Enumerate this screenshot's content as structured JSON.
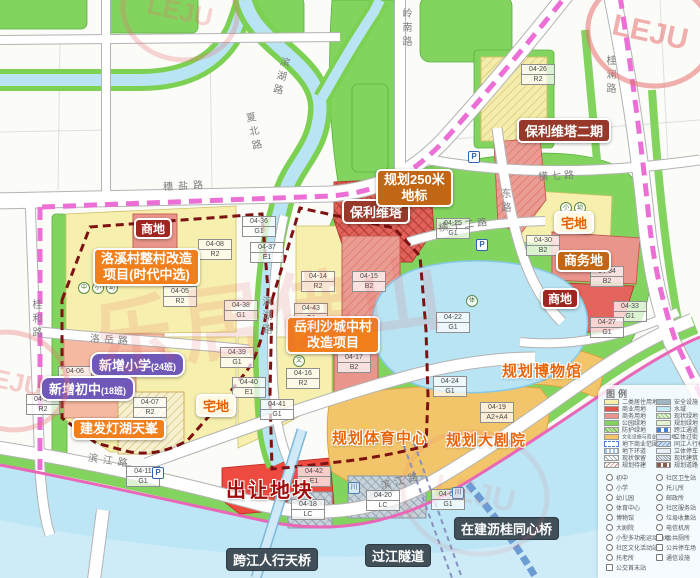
{
  "watermark": {
    "brand": "乐居佛山",
    "logo": "LEJU"
  },
  "callouts": {
    "shangdi_left": "商地",
    "luoxi_l1": "洛溪村整村改造",
    "luoxi_l2": "项目(时代中选)",
    "xiaoxue": "新增小学",
    "xiaoxue_sub": "(24班)",
    "chuzhong": "新增初中",
    "chuzhong_sub": "(18班)",
    "jianfa": "建发灯湖天峯",
    "zhaidi_left": "宅地",
    "churang": "出让地块",
    "tianqiao": "跨江人行天桥",
    "suidao": "过江隧道",
    "tongxinqiao": "在建沥桂同心桥",
    "tiyu": "规划体育中心",
    "juyuan": "规划大剧院",
    "bowuguan": "规划博物馆",
    "yuelisha_l1": "岳利沙城中村",
    "yuelisha_l2": "改造项目",
    "baoli": "保利维塔",
    "baoli2": "保利维塔二期",
    "dibiao_l1": "规划250米",
    "dibiao_l2": "地标",
    "zhaidi_right": "宅地",
    "shangwudi": "商务地",
    "shangdi_right": "商地"
  },
  "roads": {
    "suiyan": "穗盐路",
    "lingnan": "岭南路",
    "guilan": "桂澜路",
    "binhu_top": "滨湖路",
    "xiabei": "夏北路",
    "binhu_mid": "滨湖路",
    "luoyue": "洛岳路",
    "guihe": "桂和路",
    "heng7": "横七路",
    "heng12": "横十二路",
    "dong": "东路",
    "binjiang_left": "滨江路",
    "binjiang_right": "滨江路"
  },
  "blocks": [
    {
      "code": "04-36",
      "zone": "G1"
    },
    {
      "code": "04-08",
      "zone": "R2"
    },
    {
      "code": "04-37",
      "zone": "E1"
    },
    {
      "code": "04-14",
      "zone": "R2"
    },
    {
      "code": "04-15",
      "zone": "B2"
    },
    {
      "code": "04-05",
      "zone": "R2"
    },
    {
      "code": "04-38",
      "zone": "G1"
    },
    {
      "code": "04-43",
      "zone": "G1"
    },
    {
      "code": "04-39",
      "zone": "G1"
    },
    {
      "code": "04-40",
      "zone": "E1"
    },
    {
      "code": "04-16",
      "zone": "R2"
    },
    {
      "code": "04-41",
      "zone": "G1"
    },
    {
      "code": "04-35",
      "zone": "R2"
    },
    {
      "code": "04-06",
      "zone": "A3"
    },
    {
      "code": "04-07",
      "zone": "R2"
    },
    {
      "code": "04-11",
      "zone": "G1"
    },
    {
      "code": "04-42",
      "zone": "E1"
    },
    {
      "code": "04-18",
      "zone": "LC"
    },
    {
      "code": "04-20",
      "zone": "LC"
    },
    {
      "code": "04-22",
      "zone": "G1"
    },
    {
      "code": "04-24",
      "zone": "G1"
    },
    {
      "code": "04-19",
      "zone": "A2+A4"
    },
    {
      "code": "04-64",
      "zone": "G1"
    },
    {
      "code": "04-33",
      "zone": "G1"
    },
    {
      "code": "04-27",
      "zone": "G1"
    },
    {
      "code": "04-17",
      "zone": "B2"
    },
    {
      "code": "04-26",
      "zone": "R2"
    },
    {
      "code": "04-25",
      "zone": "G1"
    },
    {
      "code": "04-30",
      "zone": "B2"
    },
    {
      "code": "04-34",
      "zone": "B2"
    }
  ],
  "poi_icons": [
    {
      "glyph": "中"
    },
    {
      "glyph": "小"
    },
    {
      "glyph": "幼"
    },
    {
      "glyph": "小"
    },
    {
      "glyph": "幼"
    },
    {
      "glyph": "文"
    },
    {
      "glyph": "托"
    },
    {
      "glyph": "体"
    }
  ],
  "marks": {
    "p": "P",
    "bridge": "川"
  },
  "legend": {
    "title": "图例",
    "land1": [
      "二类居住用地",
      "商业用地",
      "商务用地",
      "公园绿地",
      "防护绿地",
      "文化设施与商业混合用地",
      "地下商业范围",
      "地下环道",
      "现状保留",
      "规划待建"
    ],
    "land2": [
      "安全设施",
      "水域",
      "现状绿地",
      "规划绿地",
      "跨江通道",
      "立体过街",
      "同江人行桥",
      "立体停车",
      "现状建筑",
      "规划道路"
    ],
    "poi1": [
      "初中",
      "小学",
      "幼儿园",
      "体育中心",
      "博物馆",
      "大剧院",
      "小型多功能运动场地",
      "社区文化活动站",
      "托老所",
      "公交首末站"
    ],
    "poi2": [
      "社区卫生站",
      "托儿所",
      "邮政所",
      "社区服务站",
      "垃圾收集站",
      "电信机房",
      "公共厕所",
      "公共停车场",
      "通信设施"
    ]
  },
  "colors": {
    "residential": "#f6efad",
    "commercial": "#e2564c",
    "business": "#ea958b",
    "park_green": "#83d45f",
    "culture_mix": "#f2c56a",
    "water": "#b9e4f4",
    "boundary_pink": "#ec6fd6",
    "boundary_maroon": "#7d1212",
    "accent_orange": "#f07f1c"
  }
}
